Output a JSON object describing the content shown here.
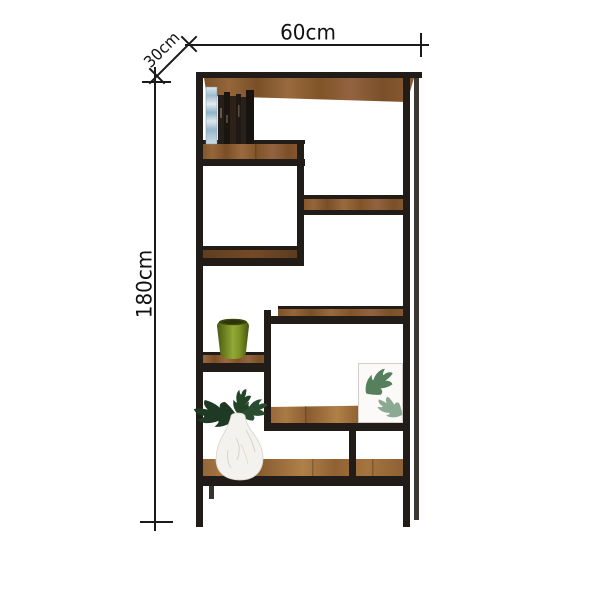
{
  "dimensions": {
    "width_label": "60cm",
    "depth_label": "30cm",
    "height_label": "180cm"
  },
  "colors": {
    "background": "#ffffff",
    "frame": "#211c18",
    "dimension_line": "#1a1a1a",
    "label_text": "#111111",
    "wood": "#8a5c33",
    "leaf_green": "#2a4a2f",
    "vase_green": "#7e9426",
    "vase_marble": "#f3f1ec"
  },
  "decor": {
    "items": [
      "books",
      "green-vase",
      "leaf-print-frame",
      "marble-vase-with-monstera"
    ]
  }
}
